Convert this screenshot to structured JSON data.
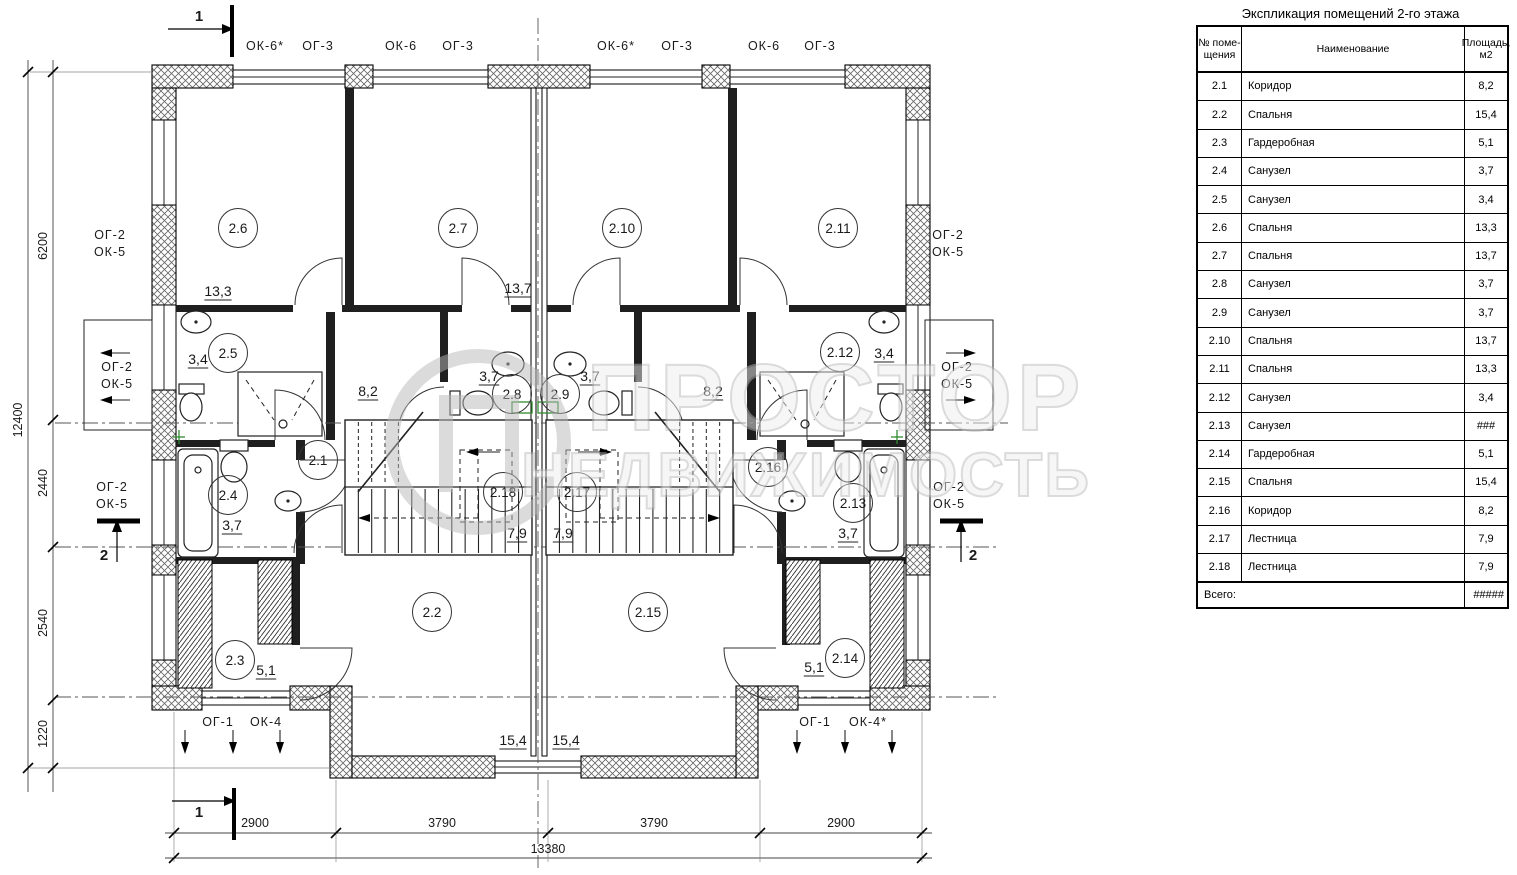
{
  "table": {
    "title": "Экспликация помещений 2-го этажа",
    "col1a": "№ поме-",
    "col1b": "щения",
    "col2": "Наименование",
    "col3": "Площадь, м2",
    "rows": [
      {
        "num": "2.1",
        "name": "Коридор",
        "area": "8,2"
      },
      {
        "num": "2.2",
        "name": "Спальня",
        "area": "15,4"
      },
      {
        "num": "2.3",
        "name": "Гардеробная",
        "area": "5,1"
      },
      {
        "num": "2.4",
        "name": "Санузел",
        "area": "3,7"
      },
      {
        "num": "2.5",
        "name": "Санузел",
        "area": "3,4"
      },
      {
        "num": "2.6",
        "name": "Спальня",
        "area": "13,3"
      },
      {
        "num": "2.7",
        "name": "Спальня",
        "area": "13,7"
      },
      {
        "num": "2.8",
        "name": "Санузел",
        "area": "3,7"
      },
      {
        "num": "2.9",
        "name": "Санузел",
        "area": "3,7"
      },
      {
        "num": "2.10",
        "name": "Спальня",
        "area": "13,7"
      },
      {
        "num": "2.11",
        "name": "Спальня",
        "area": "13,3"
      },
      {
        "num": "2.12",
        "name": "Санузел",
        "area": "3,4"
      },
      {
        "num": "2.13",
        "name": "Санузел",
        "area": "###"
      },
      {
        "num": "2.14",
        "name": "Гардеробная",
        "area": "5,1"
      },
      {
        "num": "2.15",
        "name": "Спальня",
        "area": "15,4"
      },
      {
        "num": "2.16",
        "name": "Коридор",
        "area": "8,2"
      },
      {
        "num": "2.17",
        "name": "Лестница",
        "area": "7,9"
      },
      {
        "num": "2.18",
        "name": "Лестница",
        "area": "7,9"
      }
    ],
    "total_label": "Всего:",
    "total_value": "#####"
  },
  "watermark": {
    "line1": "ПРОСТОР",
    "line2": "НЕДВИЖИМОСТЬ",
    "logo_letter": "П"
  },
  "plan": {
    "top_labels": [
      {
        "t": "ОК-6*",
        "x": 265
      },
      {
        "t": "ОГ-3",
        "x": 318
      },
      {
        "t": "ОК-6",
        "x": 401
      },
      {
        "t": "ОГ-3",
        "x": 458
      },
      {
        "t": "ОК-6*",
        "x": 616
      },
      {
        "t": "ОГ-3",
        "x": 677
      },
      {
        "t": "ОК-6",
        "x": 764
      },
      {
        "t": "ОГ-3",
        "x": 820
      }
    ],
    "side_labels": [
      {
        "l1": "ОГ-2",
        "l2": "ОК-5",
        "x": 110,
        "y": 231
      },
      {
        "l1": "ОГ-2",
        "l2": "ОК-5",
        "x": 117,
        "y": 363
      },
      {
        "l1": "ОГ-2",
        "l2": "ОК-5",
        "x": 112,
        "y": 483
      },
      {
        "l1": "ОГ-2",
        "l2": "ОК-5",
        "x": 948,
        "y": 231
      },
      {
        "l1": "ОГ-2",
        "l2": "ОК-5",
        "x": 957,
        "y": 363
      },
      {
        "l1": "ОГ-2",
        "l2": "ОК-5",
        "x": 949,
        "y": 483
      }
    ],
    "bottom_labels": [
      {
        "t": "ОГ-1",
        "x": 218
      },
      {
        "t": "ОК-4",
        "x": 266
      },
      {
        "t": "ОГ-1",
        "x": 815
      },
      {
        "t": "ОК-4*",
        "x": 868
      }
    ],
    "rooms": [
      {
        "n": "2.6",
        "x": 238,
        "y": 228
      },
      {
        "n": "2.7",
        "x": 458,
        "y": 228
      },
      {
        "n": "2.10",
        "x": 622,
        "y": 228
      },
      {
        "n": "2.11",
        "x": 838,
        "y": 228
      },
      {
        "n": "2.5",
        "x": 228,
        "y": 353
      },
      {
        "n": "2.12",
        "x": 840,
        "y": 352
      },
      {
        "n": "2.8",
        "x": 512,
        "y": 394
      },
      {
        "n": "2.9",
        "x": 560,
        "y": 394
      },
      {
        "n": "2.1",
        "x": 318,
        "y": 460
      },
      {
        "n": "2.16",
        "x": 768,
        "y": 467
      },
      {
        "n": "2.4",
        "x": 228,
        "y": 495
      },
      {
        "n": "2.13",
        "x": 853,
        "y": 503
      },
      {
        "n": "2.18",
        "x": 503,
        "y": 492
      },
      {
        "n": "2.17",
        "x": 577,
        "y": 492
      },
      {
        "n": "2.2",
        "x": 432,
        "y": 612
      },
      {
        "n": "2.15",
        "x": 648,
        "y": 612
      },
      {
        "n": "2.3",
        "x": 235,
        "y": 660
      },
      {
        "n": "2.14",
        "x": 845,
        "y": 658
      }
    ],
    "areas": [
      {
        "v": "13,3",
        "x": 218,
        "y": 291
      },
      {
        "v": "13,7",
        "x": 518,
        "y": 288
      },
      {
        "v": "3,4",
        "x": 198,
        "y": 359
      },
      {
        "v": "3,4",
        "x": 884,
        "y": 353
      },
      {
        "v": "8,2",
        "x": 368,
        "y": 391
      },
      {
        "v": "8,2",
        "x": 713,
        "y": 391
      },
      {
        "v": "3,7",
        "x": 489,
        "y": 376
      },
      {
        "v": "3,7",
        "x": 590,
        "y": 376
      },
      {
        "v": "3,7",
        "x": 232,
        "y": 525
      },
      {
        "v": "3,7",
        "x": 848,
        "y": 533
      },
      {
        "v": "7,9",
        "x": 517,
        "y": 533
      },
      {
        "v": "7,9",
        "x": 563,
        "y": 533
      },
      {
        "v": "15,4",
        "x": 513,
        "y": 740
      },
      {
        "v": "15,4",
        "x": 566,
        "y": 740
      },
      {
        "v": "5,1",
        "x": 266,
        "y": 670
      },
      {
        "v": "5,1",
        "x": 814,
        "y": 667
      }
    ],
    "dims_left": [
      {
        "v": "6200",
        "x": 47,
        "y": 246
      },
      {
        "v": "2440",
        "x": 47,
        "y": 483
      },
      {
        "v": "2540",
        "x": 47,
        "y": 623
      },
      {
        "v": "1220",
        "x": 47,
        "y": 734
      },
      {
        "v": "12400",
        "x": 22,
        "y": 420
      }
    ],
    "dims_bottom": [
      {
        "v": "2900",
        "x": 255,
        "y": 827
      },
      {
        "v": "3790",
        "x": 442,
        "y": 827
      },
      {
        "v": "3790",
        "x": 654,
        "y": 827
      },
      {
        "v": "2900",
        "x": 841,
        "y": 827
      },
      {
        "v": "13380",
        "x": 548,
        "y": 853
      }
    ],
    "sections": [
      {
        "n": "1",
        "x": 199,
        "y": 21
      },
      {
        "n": "1",
        "x": 199,
        "y": 817
      },
      {
        "n": "2",
        "x": 104,
        "y": 560
      },
      {
        "n": "2",
        "x": 973,
        "y": 560
      }
    ]
  }
}
